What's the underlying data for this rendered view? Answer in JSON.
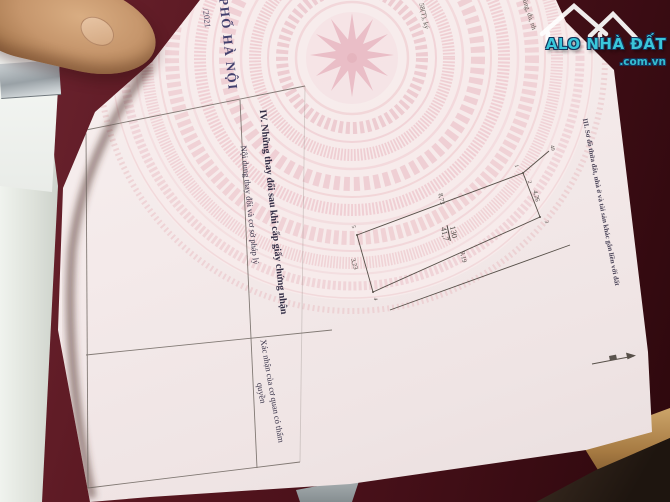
{
  "watermark": {
    "brand": "ALO NHÀ ĐẤT",
    "domain": ".com.vn"
  },
  "page": {
    "year_fragment": "/2021",
    "stamp_text": "PHỐ HÀ NỘI",
    "edge_fragment_1": "58(T), ký",
    "edge_fragment_2": "đúng, đủ, nh",
    "section3_title": "III. Sơ đồ thửa đất, nhà ở và tài sản khác gắn liền với đất",
    "section4_title": "IV. Những thay đổi sau khi cấp giấy chứng nhận",
    "column1_header": "Nội dung thay đổi và cơ sở pháp lý",
    "column2_header": "Xác nhận của cơ quan có thẩm quyền",
    "parcel": {
      "plot_number": "130",
      "area": "41,7",
      "edge_top": "8,73",
      "edge_right": "4,26",
      "edge_bottom": "9,19",
      "edge_left": "3,23",
      "adjacent_label": "49",
      "vertices": [
        "1",
        "2",
        "3",
        "4",
        "5"
      ]
    }
  },
  "colors": {
    "table_maroon": "#4E1019",
    "page_pink_pattern": "#F2CBD1",
    "watermark_teal": "#3AC6DA",
    "watermark_outline": "#15355C",
    "skin": "#C79B72",
    "wood_trim": "#A67A42"
  }
}
